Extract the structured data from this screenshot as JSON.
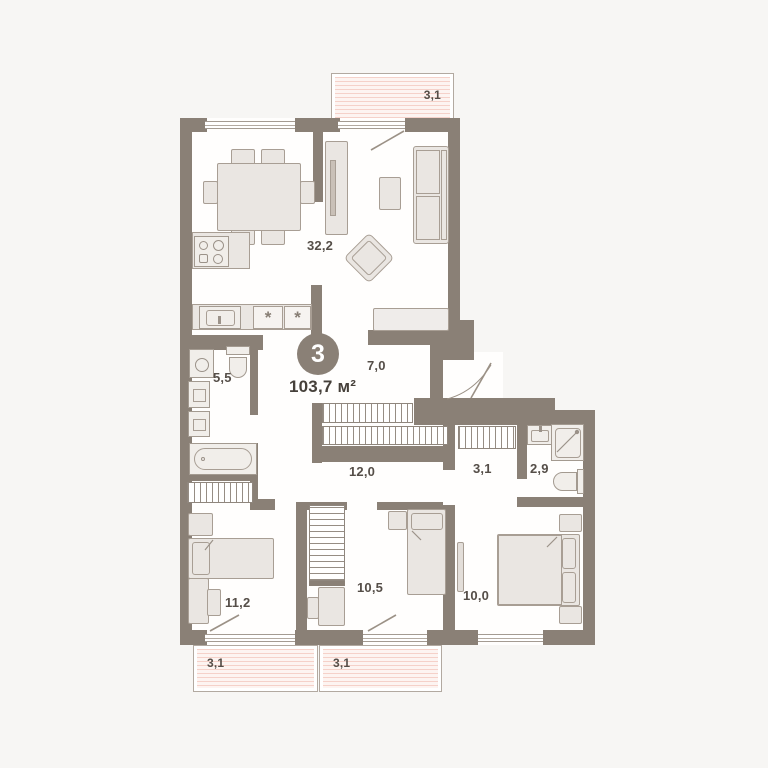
{
  "plan": {
    "badge": {
      "rooms": "3"
    },
    "total_area": "103,7 м²",
    "rooms": [
      {
        "name": "kitchen-living-room",
        "area": "32,2"
      },
      {
        "name": "hallway",
        "area": "7,0"
      },
      {
        "name": "bathroom",
        "area": "5,5"
      },
      {
        "name": "corridor",
        "area": "12,0"
      },
      {
        "name": "walk-in-closet",
        "area": "3,1"
      },
      {
        "name": "shower-room",
        "area": "2,9"
      },
      {
        "name": "bedroom-left",
        "area": "11,2"
      },
      {
        "name": "bedroom-middle",
        "area": "10,5"
      },
      {
        "name": "bedroom-right",
        "area": "10,0"
      }
    ],
    "balconies": [
      {
        "name": "balcony-top",
        "area": "3,1"
      },
      {
        "name": "balcony-bottom-left",
        "area": "3,1"
      },
      {
        "name": "balcony-bottom-middle",
        "area": "3,1"
      }
    ],
    "colors": {
      "wall": "#8a8076",
      "floor": "#ffffff",
      "furniture": "#eae6e2",
      "balcony_stripe": "#f5d1c9",
      "text": "#554e48"
    }
  }
}
